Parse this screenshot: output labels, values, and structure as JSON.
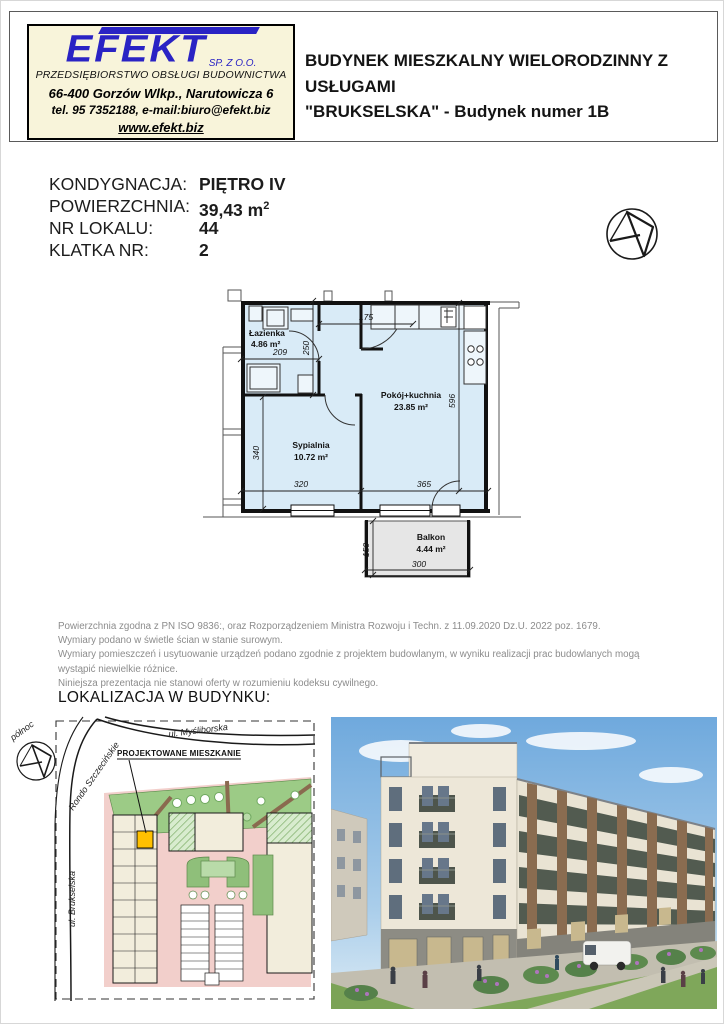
{
  "header": {
    "logo": {
      "name": "EFEKT",
      "suffix": "SP. Z O.O.",
      "subtitle": "PRZEDSIĘBIORSTWO OBSŁUGI BUDOWNICTWA",
      "address": "66-400 Gorzów Wlkp., Narutowicza 6",
      "contact": "tel. 95 7352188, e-mail:biuro@efekt.biz",
      "website": "www.efekt.biz"
    },
    "title_line1": "BUDYNEK MIESZKALNY WIELORODZINNY Z USŁUGAMI",
    "title_line2": "\"BRUKSELSKA\" - Budynek numer 1B"
  },
  "details": {
    "rows": [
      {
        "label": "KONDYGNACJA:",
        "value": "PIĘTRO IV"
      },
      {
        "label": "POWIERZCHNIA:",
        "value": "39,43 m",
        "sup": "2"
      },
      {
        "label": "NR LOKALU:",
        "value": "44"
      },
      {
        "label": "KLATKA NR:",
        "value": "2"
      }
    ]
  },
  "plan": {
    "rooms": {
      "bathroom": {
        "name": "Łazienka",
        "area": "4.86 m²"
      },
      "living": {
        "name": "Pokój+kuchnia",
        "area": "23.85 m²"
      },
      "bedroom": {
        "name": "Sypialnia",
        "area": "10.72 m²"
      },
      "balcony": {
        "name": "Balkon",
        "area": "4.44 m²"
      }
    },
    "dims": {
      "hall_w": "175",
      "bath_w": "209",
      "bath_h": "250",
      "living_h": "596",
      "bedroom_h": "340",
      "bottom_left": "320",
      "bottom_right": "365",
      "balcony_d": "150",
      "balcony_w": "300"
    }
  },
  "disclaimer": {
    "lines": [
      "Powierzchnia zgodna z PN ISO 9836:, oraz Rozporządzeniem Ministra Rozwoju i Techn. z 11.09.2020 Dz.U. 2022 poz. 1679.",
      "Wymiary podano w świetle ścian w stanie surowym.",
      "Wymiary pomieszczeń i usytuowanie urządzeń podano zgodnie z projektem budowlanym, w wyniku realizacji prac budowlanych mogą wystąpić niewielkie różnice.",
      "Niniejsza prezentacja nie stanowi oferty w rozumieniu kodeksu cywilnego."
    ]
  },
  "location": {
    "heading": "LOKALIZACJA W BUDYNKU:",
    "siteplan": {
      "north_label": "północ",
      "street_top": "ul. Myśliborska",
      "street_diag": "Rondo Szczecińskie",
      "street_left": "ul. Brukselska",
      "callout": "PROJEKTOWANE MIESZKANIE"
    }
  },
  "colors": {
    "logo_blue": "#2a23c4",
    "logo_bg": "#f8f4da",
    "plan_fill": "#d9ebf7",
    "balcony_fill": "#e6e6e6",
    "highlight_unit": "#ffc000",
    "site_green": "#9ccb86",
    "site_pink": "#f2cfcb",
    "building_cream": "#f2eddc"
  }
}
